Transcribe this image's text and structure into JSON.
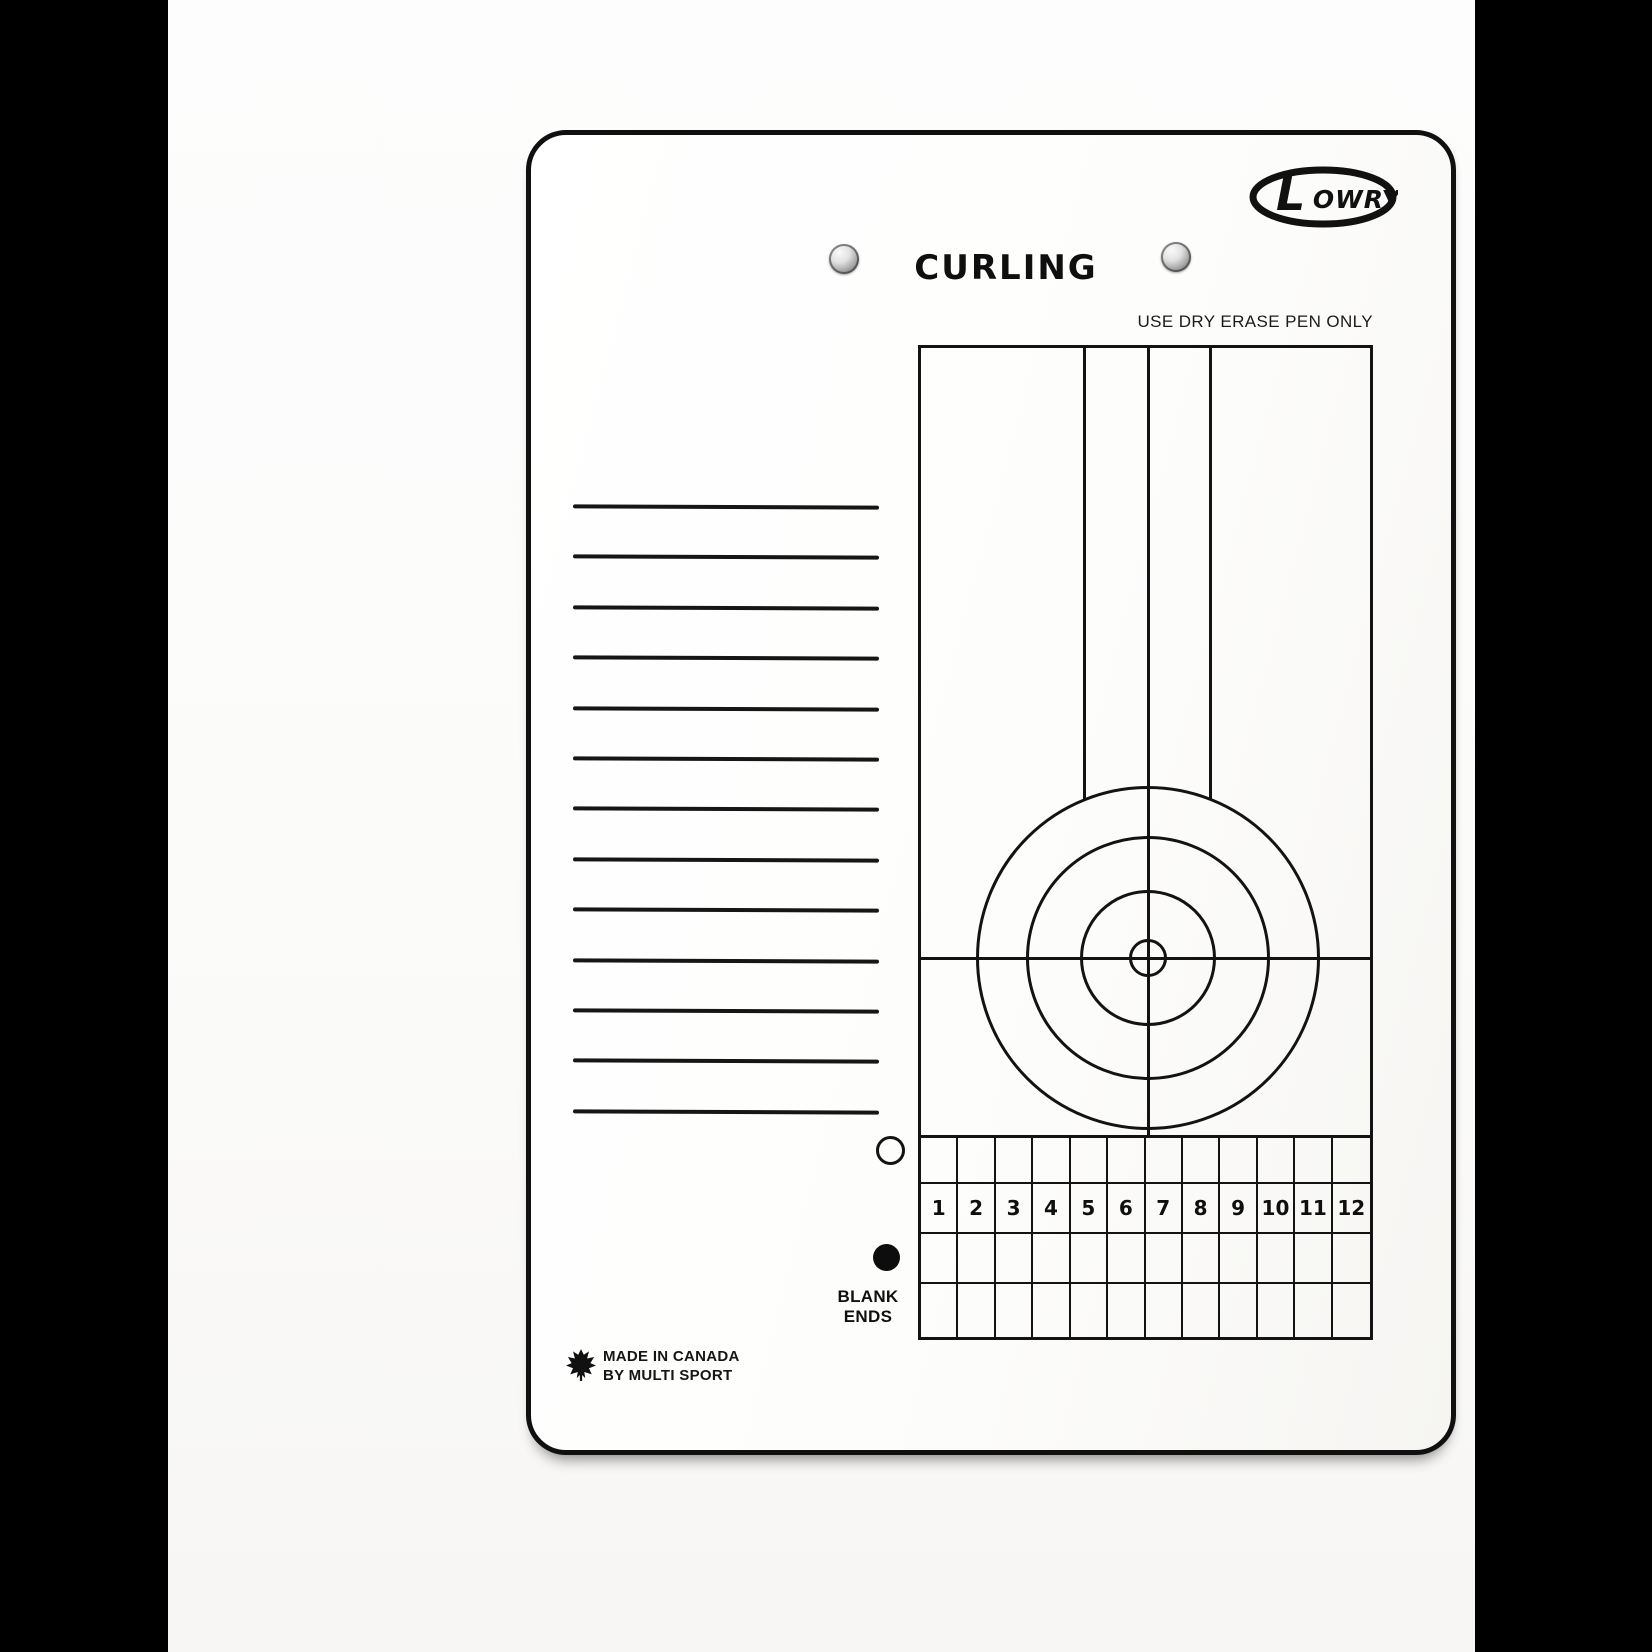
{
  "photo": {
    "letterbox_color": "#000000",
    "paper_color": "#fcfcfb"
  },
  "board": {
    "border_color": "#101010",
    "ink_color": "#131313",
    "logo": {
      "initial": "L",
      "rest": "OWRY"
    },
    "title": "CURLING",
    "instruction": "USE DRY ERASE PEN ONLY",
    "notes": {
      "line_count": 13,
      "line_spacing_px": 50.4
    },
    "sheet": {
      "vertical_guide_lines": 3,
      "house_rings": 4,
      "description": "curling house target with tee line and center line"
    },
    "score_grid": {
      "rows": 4,
      "columns": 12,
      "number_row_index": 1,
      "end_numbers": [
        "1",
        "2",
        "3",
        "4",
        "5",
        "6",
        "7",
        "8",
        "9",
        "10",
        "11",
        "12"
      ]
    },
    "blank_ends": {
      "line1": "BLANK",
      "line2": "ENDS"
    },
    "footer": {
      "line1": "MADE IN CANADA",
      "line2": "BY MULTI SPORT"
    },
    "icons": {
      "rivet": "metal-snap-fastener",
      "maple": "maple-leaf",
      "blank_open": "open-circle-marker",
      "blank_filled": "filled-circle-marker"
    }
  }
}
